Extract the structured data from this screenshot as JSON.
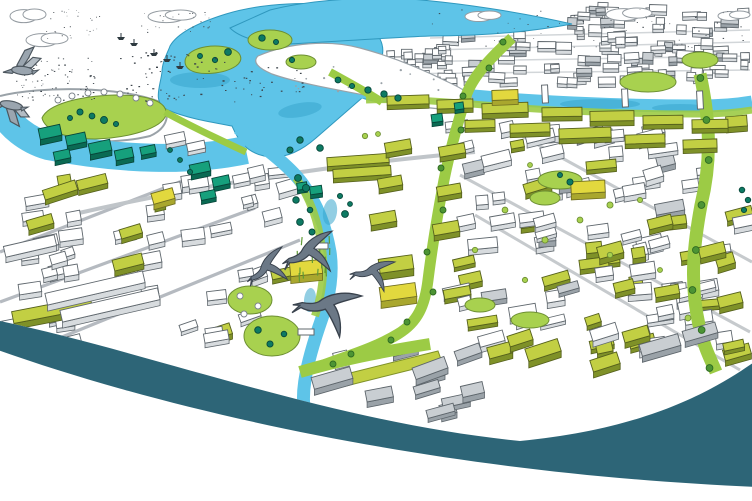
{
  "page": {
    "background": "#ffffff"
  },
  "illustration": {
    "description": "Hand-drawn aerial sketch of a riverside town masterplan with estuary, green avenues, new olive and teal buildings, existing sketched town and flying birds above a dark teal curved band",
    "colors": {
      "water": "#5ec4e8",
      "water_deep": "#39a6cc",
      "water_stroke": "#2f98be",
      "park_green": "#a8d14f",
      "park_stroke": "#6d8f33",
      "avenue_green": "#9ccb45",
      "avenue_tree": "#4c9434",
      "olive_top": "#c2cf43",
      "olive_side": "#7f9128",
      "yellow_top": "#e2d83e",
      "yellow_side": "#a9a72e",
      "teal_top": "#16a07c",
      "teal_side": "#0a6a53",
      "teal_tree": "#0d7a63",
      "sketch_line": "#5b6369",
      "roof_grey": "#9aa2a8",
      "bird_grey": "#9aa5af",
      "bird_dark": "#6b7886",
      "speck": "#3b434a",
      "swoosh": "#2d6577",
      "beach": "#ffffff"
    },
    "sky": {
      "clouds": [
        {
          "x": 26,
          "y": 33,
          "w": 42,
          "h": 13
        },
        {
          "x": 10,
          "y": 9,
          "w": 36,
          "h": 13
        },
        {
          "x": 148,
          "y": 10,
          "w": 48,
          "h": 12
        },
        {
          "x": 465,
          "y": 11,
          "w": 36,
          "h": 10
        },
        {
          "x": 606,
          "y": 8,
          "w": 46,
          "h": 12
        },
        {
          "x": 718,
          "y": 11,
          "w": 32,
          "h": 9
        }
      ],
      "flocks": [
        {
          "x": 16,
          "y": 56,
          "w": 78,
          "h": 44,
          "count": 75,
          "size": 1.7
        },
        {
          "x": 110,
          "y": 50,
          "w": 125,
          "h": 52,
          "count": 60,
          "size": 2.1
        },
        {
          "x": 140,
          "y": 12,
          "w": 75,
          "h": 20,
          "count": 26,
          "size": 1.4
        },
        {
          "x": 48,
          "y": 8,
          "w": 52,
          "h": 12,
          "count": 14,
          "size": 1.2
        },
        {
          "x": 45,
          "y": 26,
          "w": 62,
          "h": 14,
          "count": 14,
          "size": 1.3
        },
        {
          "x": 232,
          "y": 66,
          "w": 72,
          "h": 30,
          "count": 26,
          "size": 2.0
        },
        {
          "x": 428,
          "y": 8,
          "w": 315,
          "h": 40,
          "count": 60,
          "size": 1.5
        }
      ]
    },
    "birds": {
      "geese": 2,
      "swallows": 4
    },
    "water_craft": {
      "boats": [
        {
          "x": 150,
          "y": 53
        },
        {
          "x": 163,
          "y": 59
        },
        {
          "x": 176,
          "y": 66
        },
        {
          "x": 117,
          "y": 37
        },
        {
          "x": 130,
          "y": 43
        }
      ]
    }
  }
}
